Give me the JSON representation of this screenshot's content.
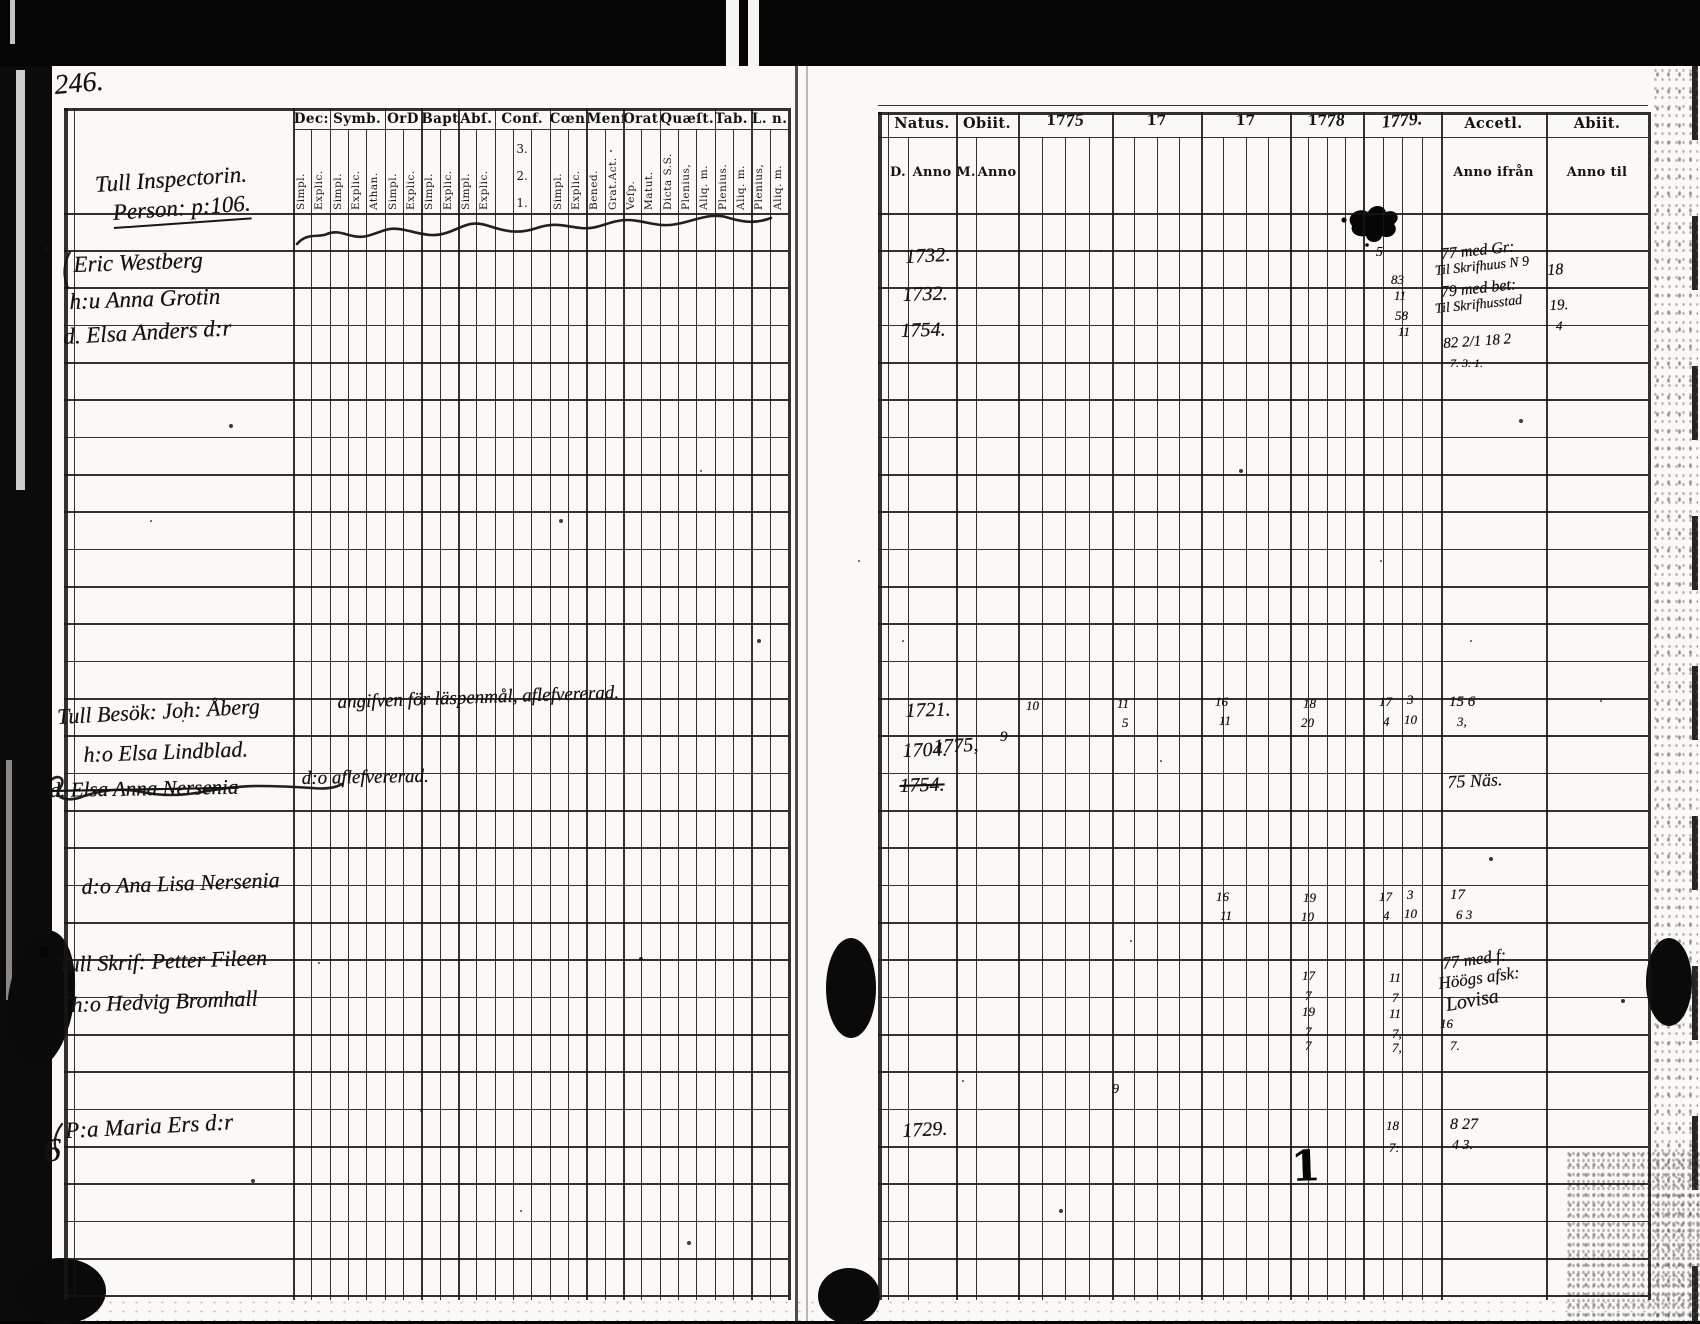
{
  "scan": {
    "page_number": "246."
  },
  "left_table": {
    "owner_line1": "Tull Inspectorin.",
    "owner_line2": "Person: p:106.",
    "margin_x_mark": "x",
    "margin_six": "6",
    "groups": [
      {
        "label": "Dec:",
        "subs": [
          "Simpl.",
          "Explic."
        ]
      },
      {
        "label": "Symb.",
        "subs": [
          "Simpl.",
          "Explic.",
          "Athan."
        ]
      },
      {
        "label": "OrD",
        "subs": [
          "Simpl.",
          "Explic."
        ]
      },
      {
        "label": "Bapt.",
        "subs": [
          "Simpl.",
          "Explic."
        ]
      },
      {
        "label": "Abſ.",
        "subs": [
          "Simpl.",
          "Explic."
        ]
      },
      {
        "label": "Conf.",
        "subs": [
          "1.",
          "2.",
          "3."
        ]
      },
      {
        "label": "Cœn D",
        "subs": [
          "Simpl.",
          "Explic."
        ]
      },
      {
        "label": "Menſ.",
        "subs": [
          "Bened.",
          "Grat.Act."
        ]
      },
      {
        "label": "Orat.",
        "subs": [
          "Veſp.",
          "Matut."
        ]
      },
      {
        "label": "Quæſt.",
        "subs": [
          "Dicta S.S.",
          "Plenius,",
          "Aliq. m."
        ]
      },
      {
        "label": "Tab. œc.",
        "subs": [
          "Plenius.",
          "Aliq. m."
        ]
      },
      {
        "label": "L. n.",
        "subs": [
          "Plenius,",
          "Aliq. m."
        ]
      }
    ]
  },
  "right_table": {
    "natus": "Natus.",
    "obiit": "Obiit.",
    "accell": "Accetl.",
    "abiit": "Abiit.",
    "sub_d": "D.",
    "sub_anno_birth": "Anno",
    "sub_m": "M.",
    "sub_anno_death": "Anno",
    "sub_anno_ifran": "Anno ifrån",
    "sub_anno_til": "Anno til",
    "years": [
      {
        "printed": "17",
        "hw": "75"
      },
      {
        "printed": "17",
        "hw": ""
      },
      {
        "printed": "17",
        "hw": ""
      },
      {
        "printed": "17",
        "hw": "78"
      },
      {
        "printed": "",
        "hw": "1779."
      }
    ]
  },
  "handwriting": [
    {
      "n": "hw-name-eric-westberg",
      "t": "Eric Westberg",
      "x": 74,
      "y": 252,
      "fs": 23,
      "rot": -2
    },
    {
      "n": "hw-name-anna-grotin",
      "t": "h:u Anna Grotin",
      "x": 70,
      "y": 289,
      "fs": 23,
      "rot": -2
    },
    {
      "n": "hw-name-elsa-anders-dr",
      "t": "d. Elsa Anders d:r",
      "x": 64,
      "y": 324,
      "fs": 23,
      "rot": -3
    },
    {
      "n": "hw-name-joh-aberg",
      "t": "Tull Besök: Joh: Åberg",
      "x": 58,
      "y": 704,
      "fs": 22,
      "rot": -3
    },
    {
      "n": "hw-note-aberg",
      "t": "angifven för läspenmål, aflefvererad.",
      "x": 338,
      "y": 692,
      "fs": 19,
      "rot": -2
    },
    {
      "n": "hw-name-elsa-lindblad",
      "t": "h:o Elsa Lindblad.",
      "x": 84,
      "y": 742,
      "fs": 22,
      "rot": -2
    },
    {
      "n": "hw-name-elsa-anna-nersenia",
      "t": "d. Elsa Anna Nersenia",
      "x": 50,
      "y": 778,
      "fs": 21,
      "rot": -1,
      "cls": "strike"
    },
    {
      "n": "hw-note-nersenia",
      "t": "d:o aflefvererad.",
      "x": 302,
      "y": 768,
      "fs": 19,
      "rot": -1
    },
    {
      "n": "hw-name-ana-lisa-nersenia",
      "t": "d:o Ana Lisa Nersenia",
      "x": 82,
      "y": 874,
      "fs": 22,
      "rot": -2
    },
    {
      "n": "hw-name-petter-fileen",
      "t": "Tull Skrif: Petter Fileen",
      "x": 58,
      "y": 952,
      "fs": 22,
      "rot": -2
    },
    {
      "n": "hw-name-hedvig-bromhall",
      "t": "h:o Hedvig Bromhall",
      "x": 72,
      "y": 992,
      "fs": 22,
      "rot": -2
    },
    {
      "n": "hw-name-maria-ers-dr",
      "t": "P:a Maria Ers d:r",
      "x": 66,
      "y": 1118,
      "fs": 23,
      "rot": -3
    },
    {
      "n": "hw-natus-1732-a",
      "t": "1732.",
      "x": 906,
      "y": 246,
      "fs": 20,
      "rot": -3
    },
    {
      "n": "hw-natus-1732-b",
      "t": "1732.",
      "x": 903,
      "y": 284,
      "fs": 20,
      "rot": -2
    },
    {
      "n": "hw-natus-1754-a",
      "t": "1754.",
      "x": 901,
      "y": 320,
      "fs": 20,
      "rot": -2
    },
    {
      "n": "hw-natus-1721",
      "t": "1721.",
      "x": 906,
      "y": 700,
      "fs": 20,
      "rot": -2
    },
    {
      "n": "hw-natus-1704",
      "t": "1704.",
      "x": 903,
      "y": 740,
      "fs": 20,
      "rot": -2
    },
    {
      "n": "hw-obiit-1775",
      "t": "1775,",
      "x": 934,
      "y": 736,
      "fs": 20,
      "rot": -3
    },
    {
      "n": "hw-obiit-month-9",
      "t": "9",
      "x": 1000,
      "y": 729,
      "fs": 15,
      "rot": 0
    },
    {
      "n": "hw-natus-1754-b",
      "t": "1754.",
      "x": 900,
      "y": 775,
      "fs": 20,
      "rot": -2,
      "cls": "strike"
    },
    {
      "n": "hw-natus-1729",
      "t": "1729.",
      "x": 903,
      "y": 1120,
      "fs": 20,
      "rot": -3
    },
    {
      "n": "hw-mark-5",
      "t": "5",
      "x": 1376,
      "y": 245,
      "fs": 14,
      "rot": 0
    },
    {
      "n": "hw-mark-83",
      "t": "83",
      "x": 1391,
      "y": 272,
      "fs": 13,
      "rot": 0
    },
    {
      "n": "hw-mark-11a",
      "t": "11",
      "x": 1394,
      "y": 288,
      "fs": 13,
      "rot": 0
    },
    {
      "n": "hw-mark-58",
      "t": "58",
      "x": 1395,
      "y": 308,
      "fs": 13,
      "rot": 0
    },
    {
      "n": "hw-mark-11b",
      "t": "11",
      "x": 1398,
      "y": 324,
      "fs": 13,
      "rot": 0
    },
    {
      "n": "hw-accell-westberg-1",
      "t": "77 med Gr:",
      "x": 1442,
      "y": 246,
      "fs": 16,
      "rot": -6
    },
    {
      "n": "hw-accell-westberg-2",
      "t": "Til Skrifhuus N 9",
      "x": 1436,
      "y": 264,
      "fs": 14,
      "rot": -6
    },
    {
      "n": "hw-abiit-westberg",
      "t": "18",
      "x": 1548,
      "y": 262,
      "fs": 16,
      "rot": -4
    },
    {
      "n": "hw-accell-grotin-1",
      "t": "79 med bet:",
      "x": 1442,
      "y": 284,
      "fs": 16,
      "rot": -6
    },
    {
      "n": "hw-accell-grotin-2",
      "t": "Til Skrifhusstad",
      "x": 1436,
      "y": 302,
      "fs": 14,
      "rot": -6
    },
    {
      "n": "hw-abiit-grotin-1",
      "t": "19.",
      "x": 1550,
      "y": 298,
      "fs": 15,
      "rot": -3
    },
    {
      "n": "hw-abiit-grotin-2",
      "t": "4",
      "x": 1556,
      "y": 318,
      "fs": 13,
      "rot": 0
    },
    {
      "n": "hw-accell-elsa-1",
      "t": "82 2/1 18 2",
      "x": 1444,
      "y": 336,
      "fs": 15,
      "rot": -4
    },
    {
      "n": "hw-accell-elsa-2",
      "t": "7. 3. 1.",
      "x": 1450,
      "y": 356,
      "fs": 12,
      "rot": 0
    },
    {
      "n": "hw-aberg-1775-10",
      "t": "10",
      "x": 1026,
      "y": 698,
      "fs": 13,
      "rot": 0
    },
    {
      "n": "hw-aberg-17a-11",
      "t": "11",
      "x": 1117,
      "y": 696,
      "fs": 13,
      "rot": 0
    },
    {
      "n": "hw-aberg-17a-5",
      "t": "5",
      "x": 1122,
      "y": 715,
      "fs": 13,
      "rot": 0
    },
    {
      "n": "hw-aberg-17b-16",
      "t": "16",
      "x": 1215,
      "y": 694,
      "fs": 13,
      "rot": 0
    },
    {
      "n": "hw-aberg-17b-11",
      "t": "11",
      "x": 1219,
      "y": 713,
      "fs": 13,
      "rot": 0
    },
    {
      "n": "hw-aberg-1778-18",
      "t": "18",
      "x": 1303,
      "y": 696,
      "fs": 13,
      "rot": 0
    },
    {
      "n": "hw-aberg-1778-20",
      "t": "20",
      "x": 1301,
      "y": 715,
      "fs": 13,
      "rot": 0
    },
    {
      "n": "hw-aberg-1779-17",
      "t": "17",
      "x": 1379,
      "y": 694,
      "fs": 13,
      "rot": 0
    },
    {
      "n": "hw-aberg-1779-4",
      "t": "4",
      "x": 1383,
      "y": 714,
      "fs": 13,
      "rot": 0
    },
    {
      "n": "hw-aberg-1779-3",
      "t": "3",
      "x": 1407,
      "y": 692,
      "fs": 13,
      "rot": 0
    },
    {
      "n": "hw-aberg-1779-10",
      "t": "10",
      "x": 1404,
      "y": 712,
      "fs": 13,
      "rot": 0
    },
    {
      "n": "hw-aberg-accell-1",
      "t": "15 6",
      "x": 1449,
      "y": 694,
      "fs": 15,
      "rot": 0
    },
    {
      "n": "hw-aberg-accell-2",
      "t": "3,",
      "x": 1457,
      "y": 714,
      "fs": 13,
      "rot": 0
    },
    {
      "n": "hw-accell-nersenia",
      "t": "75 Näs.",
      "x": 1448,
      "y": 772,
      "fs": 18,
      "rot": -3
    },
    {
      "n": "hw-analisa-17b-16",
      "t": "16",
      "x": 1216,
      "y": 889,
      "fs": 13,
      "rot": 0
    },
    {
      "n": "hw-analisa-17b-11",
      "t": "11",
      "x": 1220,
      "y": 908,
      "fs": 13,
      "rot": 0
    },
    {
      "n": "hw-analisa-1778-19",
      "t": "19",
      "x": 1303,
      "y": 890,
      "fs": 13,
      "rot": 0
    },
    {
      "n": "hw-analisa-1778-10",
      "t": "10",
      "x": 1301,
      "y": 909,
      "fs": 13,
      "rot": 0
    },
    {
      "n": "hw-analisa-1779-17",
      "t": "17",
      "x": 1379,
      "y": 889,
      "fs": 13,
      "rot": 0
    },
    {
      "n": "hw-analisa-1779-4",
      "t": "4",
      "x": 1383,
      "y": 908,
      "fs": 13,
      "rot": 0
    },
    {
      "n": "hw-analisa-1779-3",
      "t": "3",
      "x": 1407,
      "y": 887,
      "fs": 13,
      "rot": 0
    },
    {
      "n": "hw-analisa-1779-10",
      "t": "10",
      "x": 1404,
      "y": 906,
      "fs": 13,
      "rot": 0
    },
    {
      "n": "hw-analisa-accell-1",
      "t": "17",
      "x": 1450,
      "y": 887,
      "fs": 15,
      "rot": 0
    },
    {
      "n": "hw-analisa-accell-2",
      "t": "6 3",
      "x": 1456,
      "y": 907,
      "fs": 13,
      "rot": 0
    },
    {
      "n": "hw-fileen-1778-17",
      "t": "17",
      "x": 1302,
      "y": 968,
      "fs": 13,
      "rot": 0
    },
    {
      "n": "hw-fileen-1778-7",
      "t": "7",
      "x": 1305,
      "y": 988,
      "fs": 13,
      "rot": 0
    },
    {
      "n": "hw-fileen-1779-11",
      "t": "11",
      "x": 1389,
      "y": 970,
      "fs": 13,
      "rot": 0
    },
    {
      "n": "hw-fileen-1779-7",
      "t": "7",
      "x": 1392,
      "y": 990,
      "fs": 13,
      "rot": 0
    },
    {
      "n": "hw-fileen-accell-1",
      "t": "77 med f:",
      "x": 1444,
      "y": 954,
      "fs": 17,
      "rot": -8
    },
    {
      "n": "hw-fileen-accell-2",
      "t": "Höögs afsk:",
      "x": 1440,
      "y": 974,
      "fs": 17,
      "rot": -8
    },
    {
      "n": "hw-bromhall-1778-19",
      "t": "19",
      "x": 1302,
      "y": 1004,
      "fs": 13,
      "rot": 0
    },
    {
      "n": "hw-bromhall-1778-7",
      "t": "7",
      "x": 1305,
      "y": 1024,
      "fs": 13,
      "rot": 0
    },
    {
      "n": "hw-bromhall-1779-11",
      "t": "11",
      "x": 1389,
      "y": 1006,
      "fs": 13,
      "rot": 0
    },
    {
      "n": "hw-bromhall-1779-7",
      "t": "7,",
      "x": 1392,
      "y": 1026,
      "fs": 13,
      "rot": 0
    },
    {
      "n": "hw-bromhall-accell",
      "t": "Lovisa",
      "x": 1448,
      "y": 994,
      "fs": 20,
      "rot": -10
    },
    {
      "n": "hw-bromhall-accell-2",
      "t": "16",
      "x": 1440,
      "y": 1016,
      "fs": 13,
      "rot": 0
    },
    {
      "n": "hw-row-7a",
      "t": "7",
      "x": 1305,
      "y": 1038,
      "fs": 13,
      "rot": 0
    },
    {
      "n": "hw-row-7b",
      "t": "7,",
      "x": 1392,
      "y": 1040,
      "fs": 13,
      "rot": 0
    },
    {
      "n": "hw-row-7c",
      "t": "7.",
      "x": 1450,
      "y": 1038,
      "fs": 13,
      "rot": 0
    },
    {
      "n": "hw-maria-1779-18",
      "t": "18",
      "x": 1386,
      "y": 1118,
      "fs": 13,
      "rot": 0
    },
    {
      "n": "hw-maria-1779-7",
      "t": "7:",
      "x": 1389,
      "y": 1140,
      "fs": 13,
      "rot": 0
    },
    {
      "n": "hw-maria-accell-1",
      "t": "8 27",
      "x": 1450,
      "y": 1116,
      "fs": 16,
      "rot": 0
    },
    {
      "n": "hw-maria-accell-2",
      "t": "4 3.",
      "x": 1452,
      "y": 1138,
      "fs": 14,
      "rot": 0
    },
    {
      "n": "hw-stray-9",
      "t": "9",
      "x": 1112,
      "y": 1082,
      "fs": 14,
      "rot": 0
    },
    {
      "n": "hw-bold-stroke-1",
      "t": "1",
      "x": 1292,
      "y": 1142,
      "fs": 42,
      "rot": -2,
      "cls": "bold"
    }
  ]
}
